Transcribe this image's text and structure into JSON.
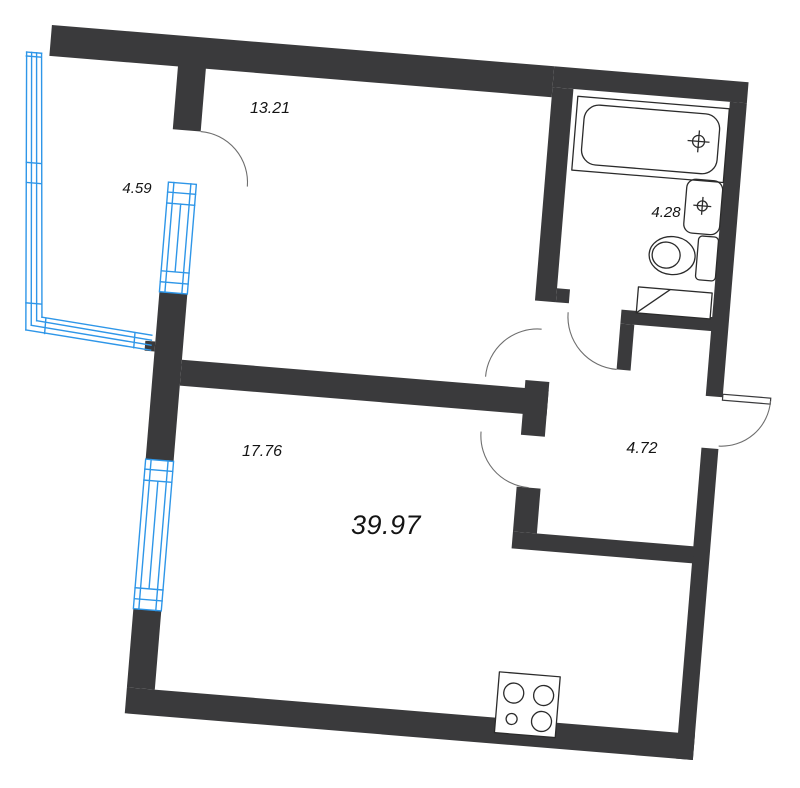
{
  "page_title": "Apartment floor plan",
  "colors": {
    "wall": "#3A3A3C",
    "glazing": "#2E96E8",
    "fixture": "#2B2B2B",
    "door_arc": "#6E6E6E",
    "text": "#141414",
    "background": "#FFFFFF"
  },
  "areas": {
    "total": "39.97",
    "room_1": "13.21",
    "living_room": "17.76",
    "balcony": "4.59",
    "bathroom": "4.28",
    "hallway": "4.72"
  },
  "symbols": [
    "bathtub",
    "sink",
    "toilet",
    "washing-machine",
    "stove",
    "window",
    "balcony-glazing",
    "door-arc",
    "entrance-door"
  ]
}
